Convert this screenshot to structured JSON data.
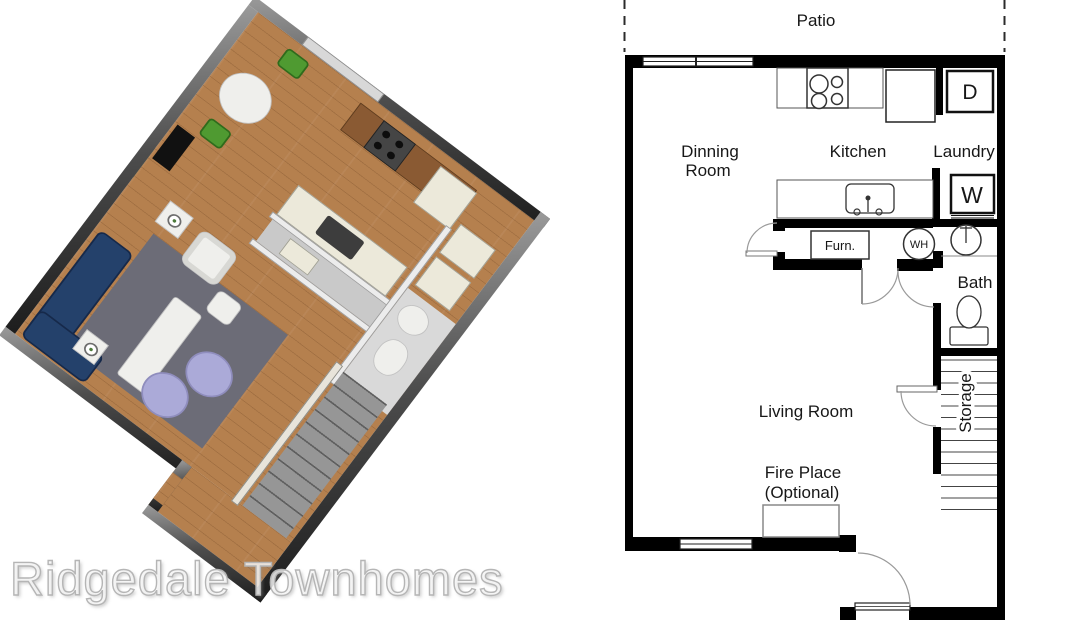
{
  "watermark": {
    "text": "Ridgedale Townhomes"
  },
  "floor_plan_2d": {
    "rooms": {
      "patio": "Patio",
      "dinning_room_line1": "Dinning",
      "dinning_room_line2": "Room",
      "kitchen": "Kitchen",
      "laundry": "Laundry",
      "bath": "Bath",
      "living_room": "Living Room",
      "fire_place_line1": "Fire Place",
      "fire_place_line2": "(Optional)",
      "storage": "Storage"
    },
    "fixtures": {
      "furnace": "Furn.",
      "water_heater": "WH",
      "dryer": "D",
      "washer": "W"
    }
  },
  "colors": {
    "plan_wall": "#000000",
    "door_swing": "#9a9a9a",
    "wood_floor": "#b5804e",
    "rug": "#6c6c77",
    "sofa_navy": "#24416b",
    "chair_green": "#4f9a31",
    "ottoman_lavender": "#abaad8",
    "stairs_gray": "#969696",
    "exterior_wall_3d": "#3a3a3a",
    "watermark_gray": "#c9c9c9"
  }
}
